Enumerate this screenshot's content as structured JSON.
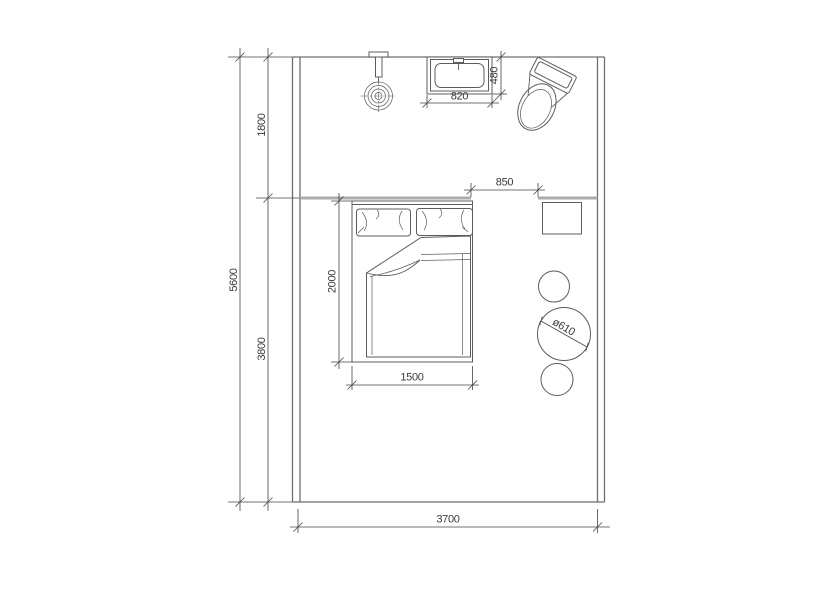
{
  "colors": {
    "background": "#ffffff",
    "wall": "#6f6f6f",
    "partition": "#ababab",
    "furniture": "#5c5c5c",
    "dimension": "#454545",
    "text": "#3a3a3a"
  },
  "labels": {
    "total_height": "5600",
    "upper_zone_height": "1800",
    "lower_zone_height": "3800",
    "room_width": "3700",
    "basin_width": "820",
    "basin_depth": "480",
    "opening_width": "850",
    "bed_length": "2000",
    "bed_width": "1500",
    "table_diameter": "ø610"
  },
  "fixtures": {
    "shower_head": "concentric-circles-on-wall-arm",
    "wash_basin": "nested-rect-basin-with-faucet",
    "toilet": "tank-with-oval-bowl-rotated",
    "double_bed": "frame-two-pillows-folded-duvet",
    "nightstand": "square-table",
    "round_table": "circle-with-diameter-dim",
    "stools": "two-small-circles"
  }
}
